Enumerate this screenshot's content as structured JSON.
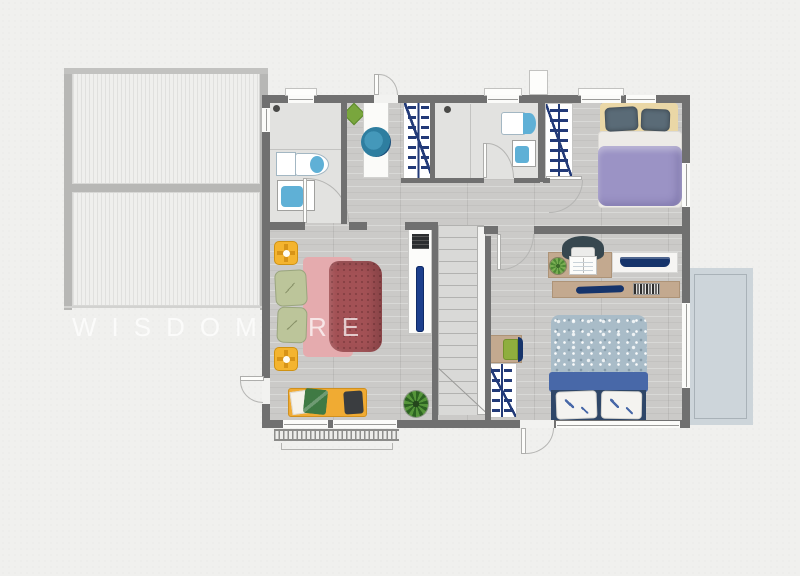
{
  "watermark": {
    "text": "WISDOM RE",
    "color": "rgba(255,255,255,0.7)"
  },
  "palette": {
    "background": "#f0f0ee",
    "wall": "#707070",
    "wood_floor": "#cbcac8",
    "bathroom_floor": "#e2e2e0",
    "roof_stripe": "#e0e0de",
    "balcony": "#cdd5da",
    "closet_hanger_navy": "#223a78",
    "master_bed_red": "#a35155",
    "master_sheet_pink": "#e5abae",
    "master_pillow_green": "#bcc59a",
    "bench_yellow": "#f0ab33",
    "spotlight_yellow": "#f4b42f",
    "purple_duvet": "#9b93c5",
    "headboard_yellow": "#ead7a6",
    "slate_pillow": "#5a6b77",
    "blue_duvet_speckle": "#a9bcc8",
    "blue_bed_band": "#4868a8",
    "blue_bed_base": "#2e4668",
    "desk_tan": "#c3a98f",
    "navy_accent": "#16346b",
    "basin_teal": "#2e7ea0",
    "plant_green": "#55953a"
  },
  "legend": {
    "areas": [
      {
        "name": "terrace-roof",
        "items": [
          "striped roof panel upper",
          "striped roof panel lower"
        ]
      },
      {
        "name": "bathroom-1",
        "items": [
          "shower",
          "toilet",
          "sink",
          "door"
        ]
      },
      {
        "name": "hall",
        "items": [
          "vanity counter",
          "round basin",
          "plant",
          "exterior door top",
          "terrace door"
        ]
      },
      {
        "name": "closets",
        "items": [
          "wardrobe hanger rail x3"
        ]
      },
      {
        "name": "bathroom-2",
        "items": [
          "shower",
          "toilet",
          "sink",
          "door"
        ]
      },
      {
        "name": "bedroom-purple",
        "items": [
          "double bed",
          "headboard",
          "two pillows",
          "wardrobe"
        ]
      },
      {
        "name": "master-bedroom",
        "items": [
          "double bed",
          "two green pillows",
          "two ceiling spotlights",
          "bench with cushions",
          "plant",
          "tv stand",
          "tv"
        ]
      },
      {
        "name": "staircase",
        "items": [
          "stairs",
          "railing"
        ]
      },
      {
        "name": "bedroom-blue",
        "items": [
          "double bed",
          "two white pillows",
          "desk",
          "office chair",
          "laptop",
          "open book",
          "plant",
          "shelf",
          "books",
          "side desk",
          "green chair",
          "wardrobe"
        ]
      },
      {
        "name": "balcony",
        "items": []
      }
    ]
  }
}
